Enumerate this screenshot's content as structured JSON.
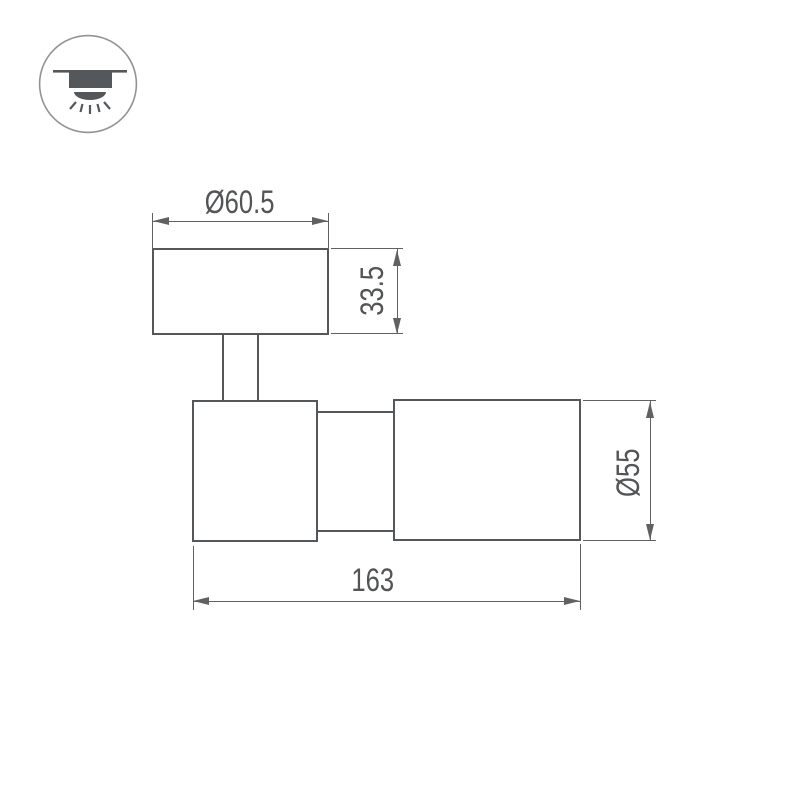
{
  "icon": {
    "name": "surface-mounted-spotlight-symbol"
  },
  "dimensions": {
    "base_diameter": {
      "label": "Ø60.5"
    },
    "base_height": {
      "label": "33.5"
    },
    "body_diameter": {
      "label": "Ø55"
    },
    "overall_length": {
      "label": "163"
    }
  },
  "colors": {
    "background": "#ffffff",
    "outline": "#54585a",
    "dim": "#5f6163",
    "text": "#525456",
    "icon": "#54585b",
    "circle": "#909496"
  }
}
